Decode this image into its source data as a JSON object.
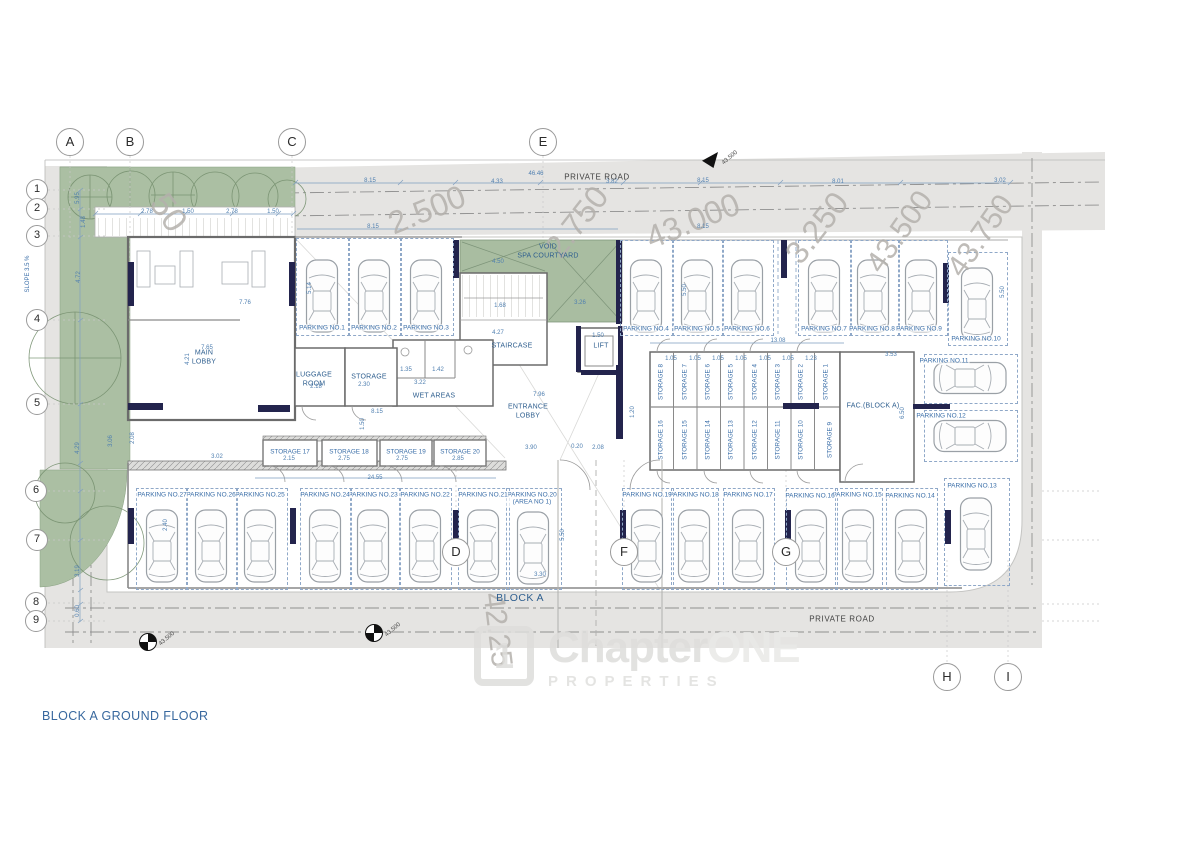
{
  "title": "BLOCK A GROUND FLOOR",
  "watermark": {
    "logo_glyph": "1",
    "brand_first": "Chapter",
    "brand_second": "ONE",
    "brand_sub": "PROPERTIES"
  },
  "road_labels": {
    "top": "PRIVATE ROAD",
    "bottom": "PRIVATE ROAD"
  },
  "block_label": "BLOCK A",
  "slope_label": "SLOPE 3.5 %",
  "colors": {
    "accent_blue": "#2f5f8f",
    "wall_navy": "#23244d",
    "landscape_green": "#abbfa3",
    "road_gray": "#e5e4e2"
  },
  "grid_bubbles": [
    {
      "label": "A",
      "x": 70,
      "y": 142,
      "r": 14
    },
    {
      "label": "B",
      "x": 130,
      "y": 142,
      "r": 14
    },
    {
      "label": "C",
      "x": 292,
      "y": 142,
      "r": 14
    },
    {
      "label": "E",
      "x": 543,
      "y": 142,
      "r": 14
    },
    {
      "label": "D",
      "x": 456,
      "y": 552,
      "r": 14
    },
    {
      "label": "F",
      "x": 624,
      "y": 552,
      "r": 14
    },
    {
      "label": "G",
      "x": 786,
      "y": 552,
      "r": 14
    },
    {
      "label": "H",
      "x": 947,
      "y": 677,
      "r": 14
    },
    {
      "label": "I",
      "x": 1008,
      "y": 677,
      "r": 14
    },
    {
      "label": "1",
      "x": 37,
      "y": 190,
      "r": 11
    },
    {
      "label": "2",
      "x": 37,
      "y": 209,
      "r": 11
    },
    {
      "label": "3",
      "x": 37,
      "y": 236,
      "r": 11
    },
    {
      "label": "4",
      "x": 37,
      "y": 320,
      "r": 11
    },
    {
      "label": "5",
      "x": 37,
      "y": 404,
      "r": 11
    },
    {
      "label": "6",
      "x": 36,
      "y": 491,
      "r": 11
    },
    {
      "label": "7",
      "x": 37,
      "y": 540,
      "r": 11
    },
    {
      "label": "8",
      "x": 36,
      "y": 603,
      "r": 11
    },
    {
      "label": "9",
      "x": 36,
      "y": 621,
      "r": 11
    }
  ],
  "room_labels": [
    {
      "n": "main-lobby",
      "lines": [
        "MAIN",
        "LOBBY"
      ],
      "x": 204,
      "y": 358
    },
    {
      "n": "luggage-room",
      "lines": [
        "LUGGAGE",
        "ROOM"
      ],
      "x": 314,
      "y": 380
    },
    {
      "n": "storage-room",
      "lines": [
        "STORAGE"
      ],
      "x": 369,
      "y": 378
    },
    {
      "n": "wet-areas",
      "lines": [
        "WET AREAS"
      ],
      "x": 434,
      "y": 397
    },
    {
      "n": "staircase",
      "lines": [
        "STAIRCASE"
      ],
      "x": 512,
      "y": 347
    },
    {
      "n": "lift",
      "lines": [
        "LIFT"
      ],
      "x": 601,
      "y": 347
    },
    {
      "n": "entrance-lobby",
      "lines": [
        "ENTRANCE",
        "LOBBY"
      ],
      "x": 528,
      "y": 412
    },
    {
      "n": "void-spa-courtyard",
      "lines": [
        "VOID",
        "SPA COURTYARD"
      ],
      "x": 548,
      "y": 252
    },
    {
      "n": "fac-block-a",
      "lines": [
        "FAC.(BLOCK A)"
      ],
      "x": 873,
      "y": 407
    }
  ],
  "parking": [
    {
      "label": "PARKING NO.1",
      "lx": 322,
      "ly": 328,
      "bay": [
        296,
        238,
        52,
        96
      ],
      "car": [
        322,
        296,
        0
      ]
    },
    {
      "label": "PARKING NO.2",
      "lx": 374,
      "ly": 328,
      "bay": [
        348,
        238,
        52,
        96
      ],
      "car": [
        374,
        296,
        0
      ]
    },
    {
      "label": "PARKING NO.3",
      "lx": 426,
      "ly": 328,
      "bay": [
        400,
        238,
        52,
        96
      ],
      "car": [
        426,
        296,
        0
      ]
    },
    {
      "label": "PARKING NO.4",
      "lx": 646,
      "ly": 329,
      "bay": [
        620,
        240,
        52,
        94
      ],
      "car": [
        646,
        296,
        0
      ]
    },
    {
      "label": "PARKING NO.5",
      "lx": 697,
      "ly": 329,
      "bay": [
        672,
        240,
        50,
        94
      ],
      "car": [
        697,
        296,
        0
      ]
    },
    {
      "label": "PARKING NO.6",
      "lx": 747,
      "ly": 329,
      "bay": [
        722,
        240,
        50,
        94
      ],
      "car": [
        747,
        296,
        0
      ]
    },
    {
      "label": "PARKING NO.7",
      "lx": 824,
      "ly": 329,
      "bay": [
        798,
        240,
        52,
        94
      ],
      "car": [
        824,
        296,
        0
      ]
    },
    {
      "label": "PARKING NO.8",
      "lx": 872,
      "ly": 329,
      "bay": [
        850,
        240,
        48,
        94
      ],
      "car": [
        873,
        296,
        0
      ]
    },
    {
      "label": "PARKING NO.9",
      "lx": 919,
      "ly": 329,
      "bay": [
        898,
        240,
        48,
        94
      ],
      "car": [
        921,
        296,
        0
      ]
    },
    {
      "label": "PARKING NO.10",
      "lx": 976,
      "ly": 339,
      "bay": [
        948,
        252,
        58,
        92
      ],
      "car": [
        977,
        304,
        0
      ]
    },
    {
      "label": "PARKING NO.11",
      "lx": 944,
      "ly": 361,
      "bay": [
        924,
        354,
        92,
        48
      ],
      "car": [
        970,
        378,
        90
      ]
    },
    {
      "label": "PARKING NO.12",
      "lx": 941,
      "ly": 416,
      "bay": [
        924,
        410,
        92,
        50
      ],
      "car": [
        970,
        436,
        90
      ]
    },
    {
      "label": "PARKING NO.13",
      "lx": 972,
      "ly": 486,
      "bay": [
        944,
        478,
        64,
        106
      ],
      "car": [
        976,
        534,
        0
      ]
    },
    {
      "label": "PARKING NO.14",
      "lx": 910,
      "ly": 496,
      "bay": [
        886,
        488,
        50,
        100
      ],
      "car": [
        911,
        546,
        0
      ]
    },
    {
      "label": "PARKING NO.15",
      "lx": 857,
      "ly": 495,
      "bay": [
        835,
        488,
        46,
        100
      ],
      "car": [
        858,
        546,
        0
      ]
    },
    {
      "label": "PARKING NO.16",
      "lx": 810,
      "ly": 496,
      "bay": [
        786,
        488,
        50,
        100
      ],
      "car": [
        811,
        546,
        0
      ]
    },
    {
      "label": "PARKING NO.17",
      "lx": 748,
      "ly": 495,
      "bay": [
        723,
        488,
        50,
        100
      ],
      "car": [
        748,
        546,
        0
      ]
    },
    {
      "label": "PARKING NO.18",
      "lx": 694,
      "ly": 495,
      "bay": [
        671,
        488,
        46,
        100
      ],
      "car": [
        694,
        546,
        0
      ]
    },
    {
      "label": "PARKING NO.19",
      "lx": 647,
      "ly": 495,
      "bay": [
        622,
        488,
        50,
        100
      ],
      "car": [
        647,
        546,
        0
      ]
    },
    {
      "lines": [
        "PARKING NO.20",
        "(AREA NO 1)"
      ],
      "lx": 532,
      "ly": 499,
      "bay": [
        506,
        488,
        54,
        100
      ],
      "car": [
        533,
        548,
        0
      ]
    },
    {
      "label": "PARKING NO.21",
      "lx": 483,
      "ly": 495,
      "bay": [
        458,
        488,
        50,
        100
      ],
      "car": [
        483,
        546,
        0
      ]
    },
    {
      "label": "PARKING NO.22",
      "lx": 425,
      "ly": 495,
      "bay": [
        400,
        488,
        50,
        100
      ],
      "car": [
        425,
        546,
        0
      ]
    },
    {
      "label": "PARKING NO.23",
      "lx": 373,
      "ly": 495,
      "bay": [
        350,
        488,
        48,
        100
      ],
      "car": [
        373,
        546,
        0
      ]
    },
    {
      "label": "PARKING NO.24",
      "lx": 325,
      "ly": 495,
      "bay": [
        300,
        488,
        50,
        100
      ],
      "car": [
        325,
        546,
        0
      ]
    },
    {
      "label": "PARKING NO.25",
      "lx": 260,
      "ly": 495,
      "bay": [
        236,
        488,
        50,
        100
      ],
      "car": [
        260,
        546,
        0
      ]
    },
    {
      "label": "PARKING NO.26",
      "lx": 211,
      "ly": 495,
      "bay": [
        186,
        488,
        50,
        100
      ],
      "car": [
        211,
        546,
        0
      ]
    },
    {
      "label": "PARKING NO.27",
      "lx": 162,
      "ly": 495,
      "bay": [
        136,
        488,
        50,
        100
      ],
      "car": [
        162,
        546,
        0
      ]
    }
  ],
  "storage_labels": [
    {
      "t": "STORAGE 17",
      "x": 290,
      "y": 452
    },
    {
      "t": "STORAGE 18",
      "x": 349,
      "y": 452
    },
    {
      "t": "STORAGE 19",
      "x": 406,
      "y": 452
    },
    {
      "t": "STORAGE 20",
      "x": 460,
      "y": 452
    },
    {
      "t": "STORAGE 8",
      "x": 661,
      "y": 382,
      "r": 1
    },
    {
      "t": "STORAGE 7",
      "x": 685,
      "y": 382,
      "r": 1
    },
    {
      "t": "STORAGE 6",
      "x": 708,
      "y": 382,
      "r": 1
    },
    {
      "t": "STORAGE 5",
      "x": 731,
      "y": 382,
      "r": 1
    },
    {
      "t": "STORAGE 4",
      "x": 755,
      "y": 382,
      "r": 1
    },
    {
      "t": "STORAGE 3",
      "x": 778,
      "y": 382,
      "r": 1
    },
    {
      "t": "STORAGE 2",
      "x": 801,
      "y": 382,
      "r": 1
    },
    {
      "t": "STORAGE 1",
      "x": 826,
      "y": 382,
      "r": 1
    },
    {
      "t": "STORAGE 16",
      "x": 661,
      "y": 440,
      "r": 1
    },
    {
      "t": "STORAGE 15",
      "x": 685,
      "y": 440,
      "r": 1
    },
    {
      "t": "STORAGE 14",
      "x": 708,
      "y": 440,
      "r": 1
    },
    {
      "t": "STORAGE 13",
      "x": 731,
      "y": 440,
      "r": 1
    },
    {
      "t": "STORAGE 12",
      "x": 755,
      "y": 440,
      "r": 1
    },
    {
      "t": "STORAGE 11",
      "x": 778,
      "y": 440,
      "r": 1
    },
    {
      "t": "STORAGE 10",
      "x": 801,
      "y": 440,
      "r": 1
    },
    {
      "t": "STORAGE 9",
      "x": 830,
      "y": 440,
      "r": 1
    }
  ],
  "contours": [
    {
      "t": "50",
      "x": 168,
      "y": 213,
      "r": 55,
      "s": 34
    },
    {
      "t": "2.500",
      "x": 427,
      "y": 210,
      "r": -22,
      "s": 32
    },
    {
      "t": "2.750",
      "x": 577,
      "y": 222,
      "r": -52,
      "s": 32
    },
    {
      "t": "43.000",
      "x": 693,
      "y": 221,
      "r": -22,
      "s": 32
    },
    {
      "t": "3.250",
      "x": 817,
      "y": 228,
      "r": -52,
      "s": 32
    },
    {
      "t": "43.500",
      "x": 900,
      "y": 232,
      "r": -55,
      "s": 30
    },
    {
      "t": "43.750",
      "x": 981,
      "y": 236,
      "r": -55,
      "s": 30
    },
    {
      "t": "42.25",
      "x": 497,
      "y": 630,
      "r": 83,
      "s": 30
    }
  ],
  "spot_levels": [
    {
      "type": "flag",
      "x": 710,
      "y": 160,
      "t": "43.500"
    },
    {
      "type": "target",
      "x": 147,
      "y": 641,
      "t": "43.500"
    },
    {
      "type": "target",
      "x": 373,
      "y": 632,
      "t": "43.500"
    }
  ],
  "dims": [
    {
      "t": "2.78",
      "x": 147,
      "y": 212
    },
    {
      "t": "1.50",
      "x": 188,
      "y": 212
    },
    {
      "t": "2.78",
      "x": 232,
      "y": 212
    },
    {
      "t": "1.50",
      "x": 273,
      "y": 212
    },
    {
      "t": "8.15",
      "x": 370,
      "y": 181
    },
    {
      "t": "4.33",
      "x": 497,
      "y": 182
    },
    {
      "t": "46.46",
      "x": 536,
      "y": 174
    },
    {
      "t": "3.82",
      "x": 612,
      "y": 182
    },
    {
      "t": "8.15",
      "x": 703,
      "y": 181
    },
    {
      "t": "8.01",
      "x": 838,
      "y": 182
    },
    {
      "t": "3.02",
      "x": 1000,
      "y": 181
    },
    {
      "t": "8.15",
      "x": 373,
      "y": 227
    },
    {
      "t": "8.15",
      "x": 703,
      "y": 227
    },
    {
      "t": "5.95",
      "x": 78,
      "y": 198,
      "r": -90
    },
    {
      "t": "1.48",
      "x": 84,
      "y": 222,
      "r": -90
    },
    {
      "t": "4.72",
      "x": 79,
      "y": 277,
      "r": -90
    },
    {
      "t": "4.29",
      "x": 78,
      "y": 448,
      "r": -90
    },
    {
      "t": "3.19",
      "x": 78,
      "y": 571,
      "r": -90
    },
    {
      "t": "0.60",
      "x": 78,
      "y": 611,
      "r": -90
    },
    {
      "t": "7.76",
      "x": 245,
      "y": 303
    },
    {
      "t": "7.65",
      "x": 207,
      "y": 348
    },
    {
      "t": "4.21",
      "x": 188,
      "y": 359,
      "r": -90
    },
    {
      "t": "2.18",
      "x": 316,
      "y": 387
    },
    {
      "t": "2.30",
      "x": 364,
      "y": 385
    },
    {
      "t": "3.22",
      "x": 420,
      "y": 383
    },
    {
      "t": "1.35",
      "x": 406,
      "y": 370
    },
    {
      "t": "1.42",
      "x": 438,
      "y": 370
    },
    {
      "t": "8.15",
      "x": 377,
      "y": 412
    },
    {
      "t": "1.50",
      "x": 363,
      "y": 424,
      "r": -90
    },
    {
      "t": "4.27",
      "x": 498,
      "y": 333
    },
    {
      "t": "1.68",
      "x": 500,
      "y": 306
    },
    {
      "t": "1.50",
      "x": 598,
      "y": 336
    },
    {
      "t": "4.50",
      "x": 498,
      "y": 262
    },
    {
      "t": "3.26",
      "x": 580,
      "y": 303
    },
    {
      "t": "7.96",
      "x": 539,
      "y": 395
    },
    {
      "t": "3.90",
      "x": 531,
      "y": 448
    },
    {
      "t": "0.20",
      "x": 577,
      "y": 447
    },
    {
      "t": "2.08",
      "x": 598,
      "y": 448
    },
    {
      "t": "1.20",
      "x": 633,
      "y": 412,
      "r": -90
    },
    {
      "t": "13.08",
      "x": 778,
      "y": 341
    },
    {
      "t": "1.05",
      "x": 671,
      "y": 359
    },
    {
      "t": "1.05",
      "x": 695,
      "y": 359
    },
    {
      "t": "1.05",
      "x": 718,
      "y": 359
    },
    {
      "t": "1.05",
      "x": 741,
      "y": 359
    },
    {
      "t": "1.05",
      "x": 765,
      "y": 359
    },
    {
      "t": "1.05",
      "x": 788,
      "y": 359
    },
    {
      "t": "1.23",
      "x": 811,
      "y": 359
    },
    {
      "t": "3.53",
      "x": 891,
      "y": 355
    },
    {
      "t": "6.50",
      "x": 903,
      "y": 413,
      "r": -90
    },
    {
      "t": "5.50",
      "x": 685,
      "y": 290,
      "r": -90
    },
    {
      "t": "5.50",
      "x": 1003,
      "y": 292,
      "r": -90
    },
    {
      "t": "5.14",
      "x": 310,
      "y": 288,
      "r": -90
    },
    {
      "t": "3.02",
      "x": 217,
      "y": 457
    },
    {
      "t": "2.15",
      "x": 289,
      "y": 459
    },
    {
      "t": "2.75",
      "x": 344,
      "y": 459
    },
    {
      "t": "2.75",
      "x": 402,
      "y": 459
    },
    {
      "t": "2.85",
      "x": 458,
      "y": 459
    },
    {
      "t": "24.55",
      "x": 375,
      "y": 478
    },
    {
      "t": "2.40",
      "x": 166,
      "y": 525,
      "r": -90
    },
    {
      "t": "3.30",
      "x": 540,
      "y": 575
    },
    {
      "t": "5.50",
      "x": 563,
      "y": 535,
      "r": -90
    },
    {
      "t": "3.06",
      "x": 111,
      "y": 441,
      "r": -90
    },
    {
      "t": "2.08",
      "x": 133,
      "y": 438,
      "r": -90
    }
  ]
}
